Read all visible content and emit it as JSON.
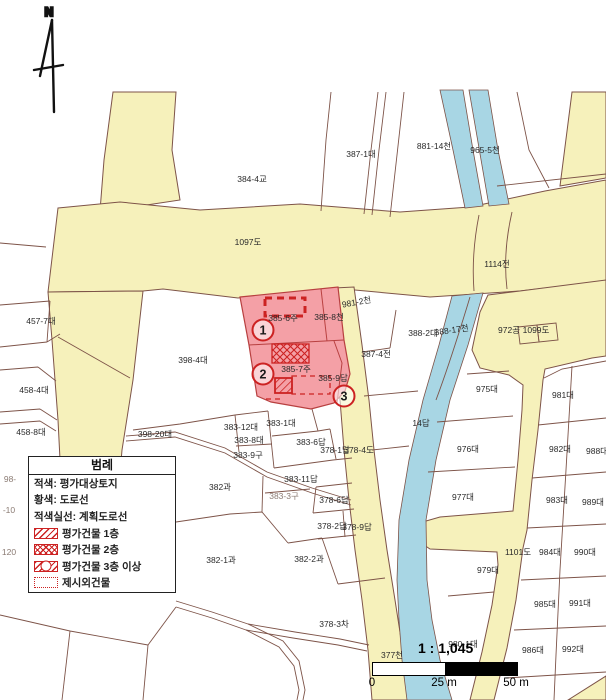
{
  "map": {
    "north_label": "N",
    "labels": [
      {
        "text": "N",
        "x": 49,
        "y": 16,
        "cls": "north"
      },
      {
        "text": "387-1대",
        "x": 361,
        "y": 157
      },
      {
        "text": "881-14천",
        "x": 434,
        "y": 149
      },
      {
        "text": "965-5천",
        "x": 485,
        "y": 153
      },
      {
        "text": "384-4교",
        "x": 252,
        "y": 182
      },
      {
        "text": "1097도",
        "x": 248,
        "y": 245
      },
      {
        "text": "1114전",
        "x": 497,
        "y": 267
      },
      {
        "text": "457-7대",
        "x": 41,
        "y": 324
      },
      {
        "text": "458-4대",
        "x": 34,
        "y": 393
      },
      {
        "text": "458-8대",
        "x": 31,
        "y": 435
      },
      {
        "text": "98-",
        "x": 10,
        "y": 482,
        "cls": "faint"
      },
      {
        "text": "-10",
        "x": 9,
        "y": 513,
        "cls": "faint"
      },
      {
        "text": "120",
        "x": 9,
        "y": 555,
        "cls": "faint"
      },
      {
        "text": "398-4대",
        "x": 193,
        "y": 363
      },
      {
        "text": "398-20대",
        "x": 155,
        "y": 437
      },
      {
        "text": "383-12대",
        "x": 241,
        "y": 430
      },
      {
        "text": "383-1대",
        "x": 281,
        "y": 426
      },
      {
        "text": "383-8대",
        "x": 249,
        "y": 443
      },
      {
        "text": "383-9구",
        "x": 248,
        "y": 458
      },
      {
        "text": "383-6답",
        "x": 311,
        "y": 445
      },
      {
        "text": "378-1답",
        "x": 335,
        "y": 453
      },
      {
        "text": "378-4도",
        "x": 359,
        "y": 453
      },
      {
        "text": "383-11답",
        "x": 301,
        "y": 482
      },
      {
        "text": "382과",
        "x": 220,
        "y": 490
      },
      {
        "text": "383-3구",
        "x": 284,
        "y": 499,
        "cls": "faint"
      },
      {
        "text": "378-6답",
        "x": 334,
        "y": 503
      },
      {
        "text": "378-2답",
        "x": 332,
        "y": 529
      },
      {
        "text": "378-9답",
        "x": 357,
        "y": 530
      },
      {
        "text": "382-1과",
        "x": 221,
        "y": 563
      },
      {
        "text": "382-2과",
        "x": 309,
        "y": 562
      },
      {
        "text": "378-3차",
        "x": 334,
        "y": 627
      },
      {
        "text": "377천",
        "x": 392,
        "y": 658
      },
      {
        "text": "385-6주",
        "x": 283,
        "y": 321
      },
      {
        "text": "385-8천",
        "x": 329,
        "y": 320
      },
      {
        "text": "981-2천",
        "x": 357,
        "y": 305,
        "rot": -10
      },
      {
        "text": "385-7주",
        "x": 296,
        "y": 372
      },
      {
        "text": "385-9답",
        "x": 333,
        "y": 381
      },
      {
        "text": "388-2대",
        "x": 423,
        "y": 336
      },
      {
        "text": "388-17천",
        "x": 452,
        "y": 333,
        "rot": -8
      },
      {
        "text": "972공",
        "x": 509,
        "y": 333
      },
      {
        "text": "1099도",
        "x": 536,
        "y": 333
      },
      {
        "text": "387-4전",
        "x": 376,
        "y": 357
      },
      {
        "text": "14답",
        "x": 421,
        "y": 426
      },
      {
        "text": "975대",
        "x": 487,
        "y": 392
      },
      {
        "text": "976대",
        "x": 468,
        "y": 452
      },
      {
        "text": "977대",
        "x": 463,
        "y": 500
      },
      {
        "text": "979대",
        "x": 488,
        "y": 573
      },
      {
        "text": "980-1대",
        "x": 463,
        "y": 647
      },
      {
        "text": "1101도",
        "x": 518,
        "y": 555
      },
      {
        "text": "981대",
        "x": 563,
        "y": 398
      },
      {
        "text": "982대",
        "x": 560,
        "y": 452
      },
      {
        "text": "983대",
        "x": 557,
        "y": 503
      },
      {
        "text": "984대",
        "x": 550,
        "y": 555
      },
      {
        "text": "985대",
        "x": 545,
        "y": 607
      },
      {
        "text": "986대",
        "x": 533,
        "y": 653
      },
      {
        "text": "988대",
        "x": 597,
        "y": 454
      },
      {
        "text": "989대",
        "x": 593,
        "y": 505
      },
      {
        "text": "990대",
        "x": 585,
        "y": 555
      },
      {
        "text": "991대",
        "x": 580,
        "y": 606
      },
      {
        "text": "992대",
        "x": 573,
        "y": 652
      }
    ],
    "callouts": [
      {
        "n": "1",
        "x": 263,
        "y": 330
      },
      {
        "n": "2",
        "x": 263,
        "y": 374
      },
      {
        "n": "3",
        "x": 344,
        "y": 396
      }
    ]
  },
  "legend": {
    "title": "범례",
    "rows": [
      {
        "label": "적색: 평가대상토지",
        "swatch": "none"
      },
      {
        "label": "황색: 도로선",
        "swatch": "none"
      },
      {
        "label": "적색실선: 계획도로선",
        "swatch": "none"
      },
      {
        "label": "평가건물 1층",
        "swatch": "hatch-diagonal"
      },
      {
        "label": "평가건물 2층",
        "swatch": "hatch-cross"
      },
      {
        "label": "평가건물 3층 이상",
        "swatch": "hatch-circle"
      },
      {
        "label": "제시외건물",
        "swatch": "dotted-outline"
      }
    ]
  },
  "scale": {
    "ratio": "1 : 1,045",
    "tick0": "0",
    "tick1": "25 m",
    "tick2": "50 m"
  },
  "colors": {
    "road": "#f6f1bb",
    "stream": "#a8d6e4",
    "target_parcel": "#f4a0a6",
    "parcel_line": "#7d5348",
    "building_red": "#cc2222"
  }
}
